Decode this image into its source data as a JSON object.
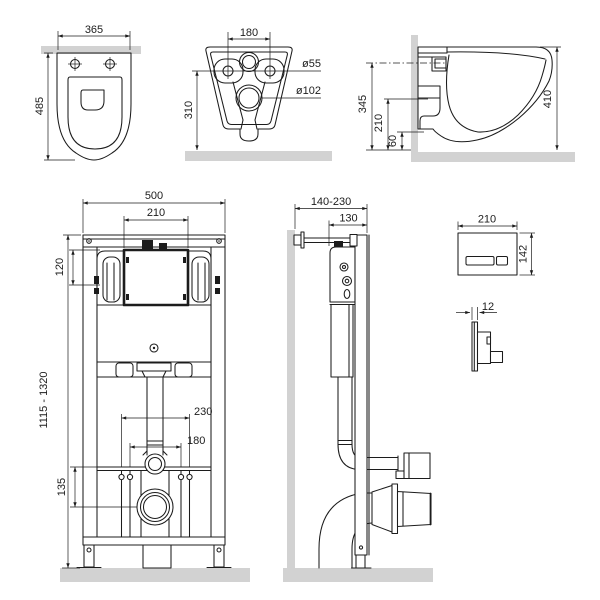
{
  "colors": {
    "line": "#1c1c1c",
    "surface_fill": "#d2d2d2",
    "background": "#ffffff"
  },
  "views": {
    "bowl_top": {
      "width": "365",
      "depth": "485"
    },
    "bowl_rear": {
      "hole_spacing": "180",
      "small_hole": "ø55",
      "large_hole": "ø102",
      "height": "310"
    },
    "bowl_side": {
      "inlet_height": "345",
      "outlet_height": "210",
      "rim_offset": "60",
      "total_height": "410"
    },
    "frame_front": {
      "width": "500",
      "opening_width": "210",
      "opening_height": "120",
      "height_range": "1115 - 1320",
      "fixing_outer": "230",
      "fixing_inner": "180",
      "outlet_height": "135"
    },
    "frame_side": {
      "depth_range": "140-230",
      "depth": "130"
    },
    "flush_plate": {
      "width": "210",
      "height": "142",
      "thickness": "12"
    }
  }
}
